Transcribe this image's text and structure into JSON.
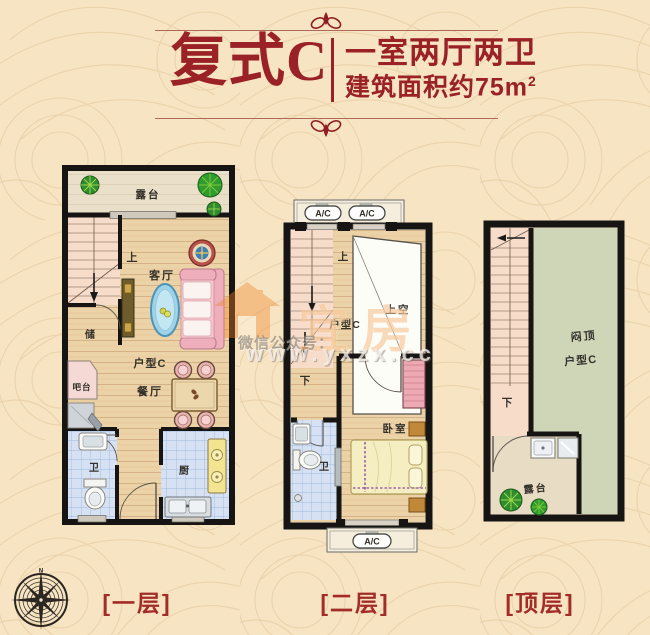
{
  "header": {
    "unit_name": "复式C",
    "layout_desc": "一室两厅两卫",
    "area_desc": "建筑面积约75m",
    "area_sup": "2"
  },
  "floor1": {
    "caption": "[一层]",
    "terrace": "露台",
    "living": "客厅",
    "storage": "储",
    "bar": "吧台",
    "unit": "户型C",
    "dining": "餐厅",
    "bath": "卫",
    "kitchen": "厨",
    "stair_up": "上"
  },
  "floor2": {
    "caption": "[二层]",
    "unit": "户型C",
    "void": "上空",
    "bedroom": "卧室",
    "bath": "卫",
    "stair_up": "上",
    "stair_down": "下",
    "ac": "A/C"
  },
  "floor3": {
    "caption": "[顶层]",
    "attic_line1": "闷顶",
    "attic_line2": "户型C",
    "terrace": "露台",
    "stair_down": "下"
  },
  "watermark": {
    "prefix": "微信公众号：",
    "brand": "宜房",
    "url": "www.yxzx.cc"
  },
  "compass": {
    "north": "N"
  },
  "colors": {
    "accent_red": "#9a2125",
    "rule_red": "#ad6a58",
    "wall_black": "#171513",
    "background": "#f7e4c3",
    "wood_floor": "#ecd3a7",
    "stair_pink": "#f8dcca",
    "tile_blue": "#d6e2f3",
    "attic_green": "#cfd6b8",
    "terrace_tan": "#eae0ca",
    "sofa_pink": "#f6c6ce",
    "bed_yellow": "#f4eec2",
    "plant_green": "#2f8c2f"
  }
}
